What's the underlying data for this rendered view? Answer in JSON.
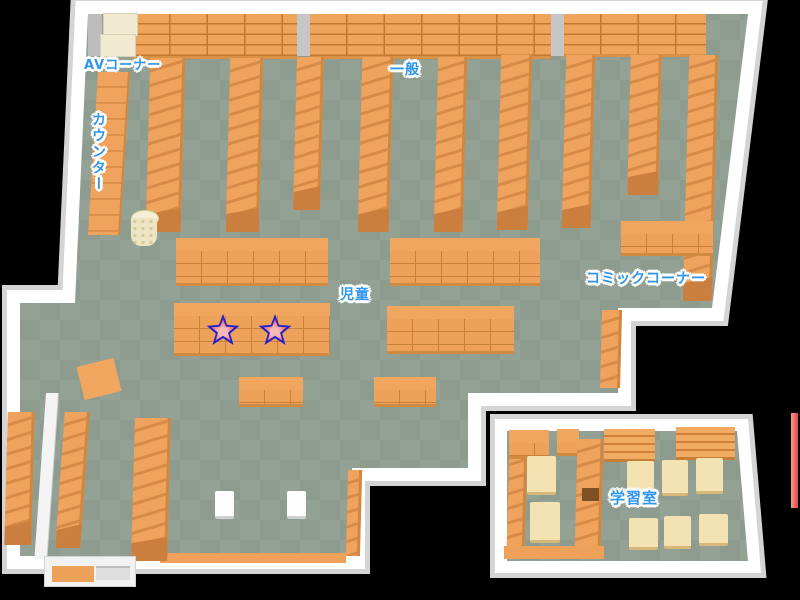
{
  "labels": {
    "av_corner": "AVコーナー",
    "general": "一般",
    "counter": "カウンター",
    "children": "児童",
    "comic_corner": "コミックコーナー",
    "study_room": "学習室"
  },
  "markers": {
    "star_count": 2,
    "star_fill": "#ee5f5f",
    "star_outline": "#2121cc"
  },
  "colors": {
    "background": "#000000",
    "wall": "#ffffff",
    "wall_rim": "#d4d4d4",
    "floor_light": "#93a295",
    "floor_dark": "#8d9c8f",
    "shelf_orange": "#efa35d",
    "shelf_edge": "#c8813c",
    "table_cream": "#f3e3b2",
    "label_blue": "#2f96f0",
    "accent_red_line": "#e8453c"
  }
}
